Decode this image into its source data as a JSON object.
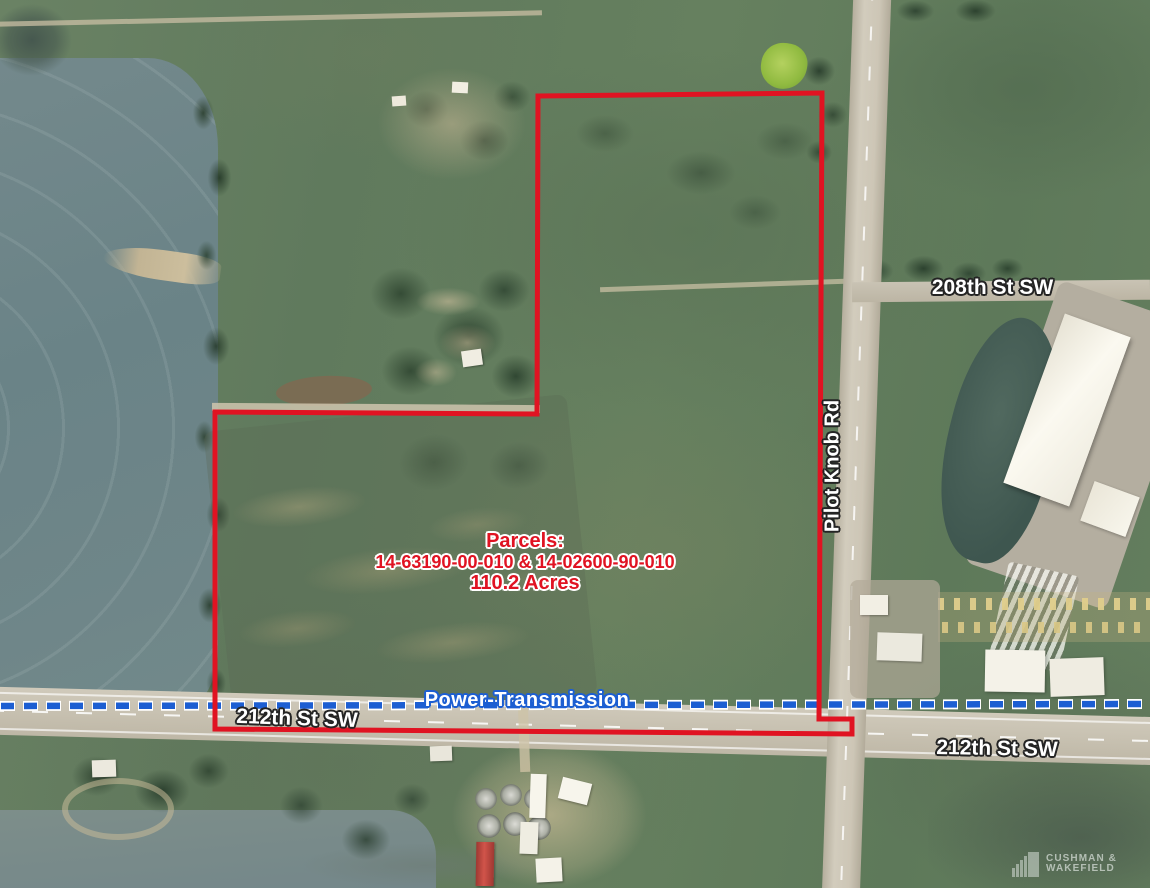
{
  "annotations": {
    "parcels": {
      "title": "Parcels:",
      "ids": "14-63190-00-010 & 14-02600-90-010",
      "acres": "110.2 Acres"
    },
    "power_line": {
      "label": "Power-Transmission"
    },
    "roads": {
      "st_208": "208th St SW",
      "pilot_knob": "Pilot Knob Rd",
      "st_212_left": "212th St SW",
      "st_212_right": "212th St SW"
    }
  },
  "watermark": {
    "brand_line1": "CUSHMAN &",
    "brand_line2": "WAKEFIELD"
  },
  "colors": {
    "boundary_red": "#e01322",
    "parcel_text_red": "#e01322",
    "power_line_blue": "#1c5ed2",
    "power_line_casing": "#ffffff",
    "road_label_fill": "#ffffff",
    "road_label_outline": "#242424"
  }
}
